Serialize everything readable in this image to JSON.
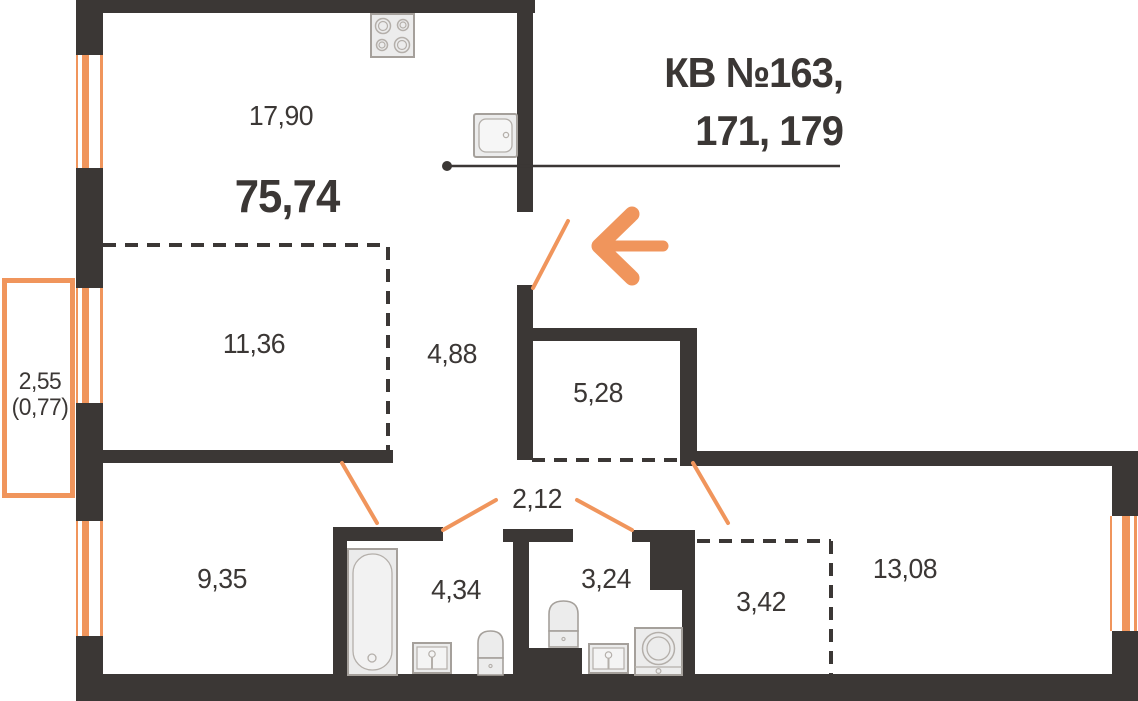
{
  "title": {
    "line1": "КВ №163,",
    "line2": "171, 179"
  },
  "total_area": "75,74",
  "rooms": {
    "living_kitchen": "17,90",
    "bedroom1": "11,36",
    "hallway": "4,88",
    "pantry": "5,28",
    "corridor": "2,12",
    "bedroom2": "9,35",
    "bathroom": "4,34",
    "wc": "3,24",
    "wardrobe": "3,42",
    "bedroom3": "13,08"
  },
  "balcony": {
    "area": "2,55",
    "area_reduced": "(0,77)"
  },
  "colors": {
    "wall": "#3B3735",
    "accent": "#F0955C",
    "fixture_fill": "#ECECEC",
    "fixture_stroke": "#A5A09B",
    "fixture_inner": "#B4AFAA"
  },
  "icons": {
    "stove": "stove-icon",
    "kitchen_sink": "sink-icon",
    "bathtub": "bathtub-icon",
    "toilets": "toilet-icon",
    "washer": "washing-machine-icon",
    "entrance": "entrance-arrow-icon"
  }
}
